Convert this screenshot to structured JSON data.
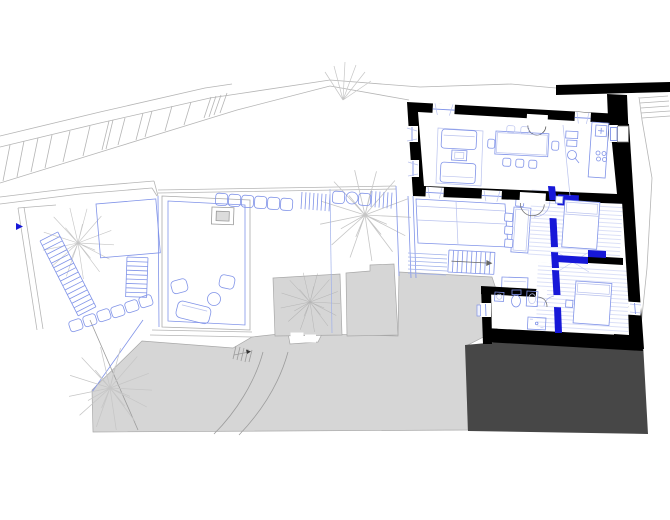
{
  "document": {
    "kind": "architectural plan drawing",
    "content": "site plan with terraced garden, parking band, existing stone building (black walls) with furnished rooms, new partition walls in blue, neighbouring roofs in gray"
  },
  "palette": {
    "background": "#ffffff",
    "wall_black": "#000000",
    "new_wall_blue": "#1718d8",
    "furniture_blue": "#8093e8",
    "furniture_blue_light": "#b9c2ee",
    "hatch_blue": "#ccd2f4",
    "site_line_gray": "#b5b5b5",
    "detail_gray": "#9c9c9c",
    "roof_gray_fill": "#d6d6d6",
    "roof_gray_edge": "#a8a8a8",
    "dark_roof": "#474747",
    "tree_gray": "#c6c6c6",
    "stipple_gray": "#a3a3a3"
  },
  "legend": {
    "black_fill": "existing walls",
    "blue_fill": "new walls",
    "blue_lines": "furniture, stairs, planting, windows",
    "light_gray_fill": "adjacent roofs / terrain",
    "dark_gray_fill": "lower building roof",
    "stipple": "planting bed",
    "line_hatch": "wood flooring"
  }
}
